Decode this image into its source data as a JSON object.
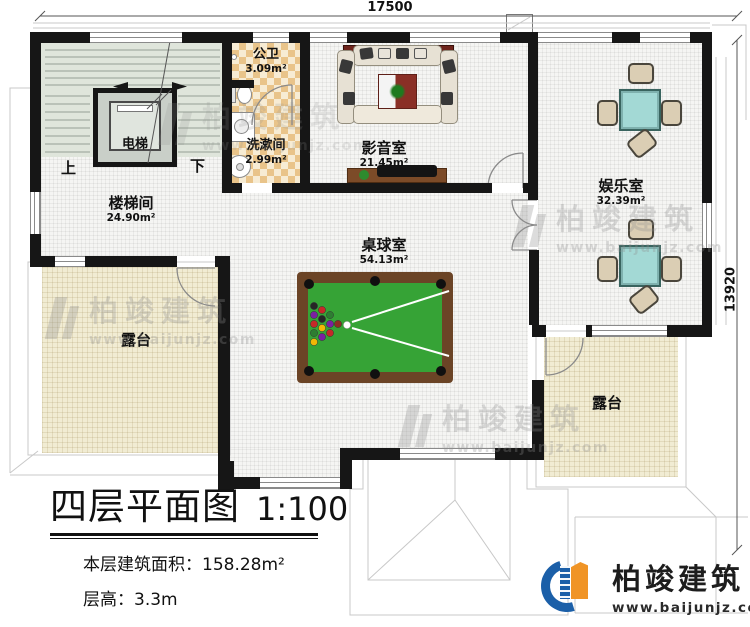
{
  "dimensions": {
    "top_width": "17500",
    "right_height": "13920"
  },
  "rooms": {
    "stairwell": {
      "name": "楼梯间",
      "area": "24.90m²"
    },
    "elevator": {
      "name": "电梯"
    },
    "public_bath": {
      "name": "公卫",
      "area": "3.09m²"
    },
    "washroom": {
      "name": "洗漱间",
      "area": "2.99m²"
    },
    "media_room": {
      "name": "影音室",
      "area": "21.45m²"
    },
    "entertainment_room": {
      "name": "娱乐室",
      "area": "32.39m²"
    },
    "billiards_room": {
      "name": "桌球室",
      "area": "54.13m²"
    },
    "terrace_left": {
      "name": "露台"
    },
    "terrace_right": {
      "name": "露台"
    }
  },
  "stair_labels": {
    "up": "上",
    "down": "下"
  },
  "title_block": {
    "title": "四层平面图",
    "scale": "1:100",
    "area_line": "本层建筑面积：158.28m²",
    "floor_height_line": "层高：3.3m"
  },
  "branding": {
    "company": "柏竣建筑",
    "website": "www.baijunjz.com"
  },
  "watermark": {
    "company": "柏竣建筑",
    "website": "www.baijunjz.com"
  },
  "colors": {
    "wall": "#161616",
    "terrace_floor": "#f1ecd3",
    "checker_tile": "#e9c48a",
    "stair_floor": "#dfe5db",
    "pool_felt": "#36a336",
    "pool_frame": "#6b4426",
    "mahjong_table": "#a3d9d5",
    "logo_blue": "#1b5fa8",
    "logo_orange": "#f09426"
  }
}
